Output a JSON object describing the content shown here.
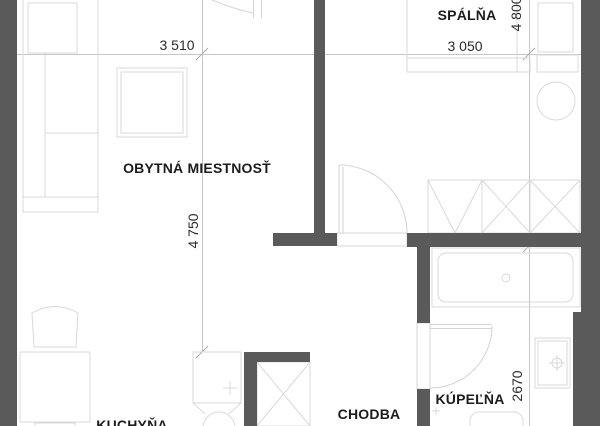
{
  "floor_plan": {
    "background_color": "#ffffff",
    "wall_color": "#5a5a5a",
    "furniture_line_color": "#d9d9d9",
    "dimension_line_color": "#c6c6c6",
    "label_color": "#1c1c1c",
    "rooms": [
      {
        "name": "living-room",
        "label": "OBYTNÁ MIESTNOSŤ"
      },
      {
        "name": "bedroom",
        "label": "SPÁLŇA"
      },
      {
        "name": "hallway",
        "label": "CHODBA"
      },
      {
        "name": "bathroom",
        "label": "KÚPEĽŇA"
      },
      {
        "name": "kitchen",
        "label": "KUCHYŇA"
      }
    ],
    "dimensions": [
      {
        "name": "living-room-width",
        "label": "3 510",
        "orientation": "horizontal"
      },
      {
        "name": "bedroom-width",
        "label": "3 050",
        "orientation": "horizontal"
      },
      {
        "name": "bedroom-depth",
        "label": "4 800",
        "orientation": "vertical"
      },
      {
        "name": "living-room-depth",
        "label": "4 750",
        "orientation": "vertical"
      },
      {
        "name": "bathroom-depth",
        "label": "2670",
        "orientation": "vertical"
      }
    ]
  }
}
